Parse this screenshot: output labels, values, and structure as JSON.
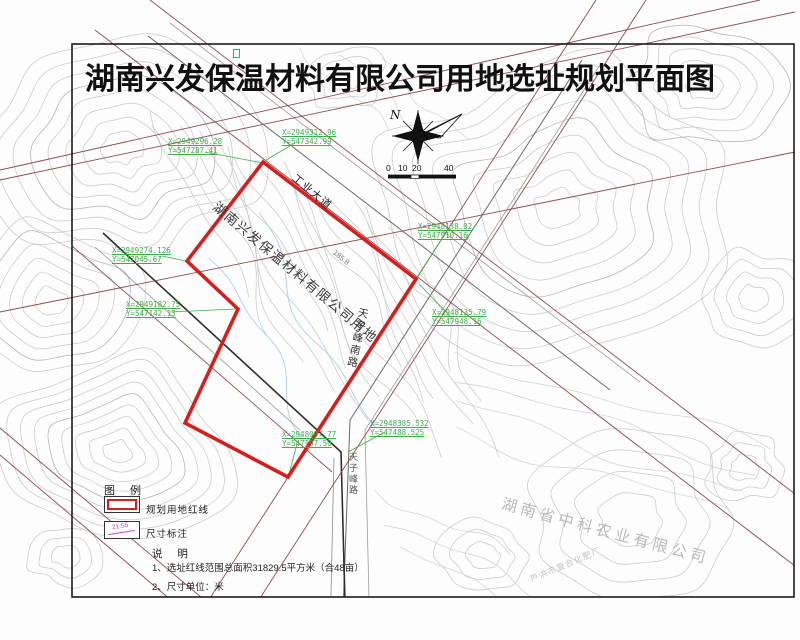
{
  "title": {
    "prefix": "湖南兴发保温材料有限公司用地",
    "suffix": "选址规划平面图"
  },
  "compass": {
    "north_label": "N"
  },
  "scale_bar": {
    "ticks": [
      "0",
      "10",
      "20",
      "40"
    ]
  },
  "map_labels": {
    "site_parcel": "湖南兴发保温材料有限公司用地",
    "road_industrial": "工业大道",
    "road_tianzifeng_south": "天子峰南路",
    "road_tianzifeng": "天子峰路",
    "spot_elevation": "185.8",
    "company_agriculture": "湖南省中科农业有限公司",
    "fertilizer_factory": "芦洪市复合化肥厂"
  },
  "coordinates": [
    {
      "x": "X=2949296.28",
      "y": "Y=547287.41"
    },
    {
      "x": "X=2949312.96",
      "y": "Y=547342.99"
    },
    {
      "x": "X=2949274.126",
      "y": "Y=547045.67"
    },
    {
      "x": "X=2949182.75",
      "y": "Y=547142.13"
    },
    {
      "x": "X=2948138.02",
      "y": "Y=547910.16"
    },
    {
      "x": "X=2948135.79",
      "y": "Y=547948.16"
    },
    {
      "x": "X=2948385.532",
      "y": "Y=547488.525"
    },
    {
      "x": "X=2948097.77",
      "y": "Y=547197.50"
    }
  ],
  "legend": {
    "header": "图  例",
    "items": [
      {
        "label": "规划用地红线"
      },
      {
        "label": "尺寸标注",
        "symbol_text": "21.55"
      }
    ]
  },
  "notes": {
    "header": "说  明",
    "items": [
      "1、选址红线范围总面积31829.5平方米（合48亩）",
      "2、尺寸单位：米"
    ]
  },
  "colors": {
    "red_line": "#d51f1f",
    "coordinate_green": "#3fae49",
    "planning_line": "#8e4c4c",
    "dimension_magenta": "#cc3fcc",
    "contour_gray": "#c9c9c9"
  }
}
